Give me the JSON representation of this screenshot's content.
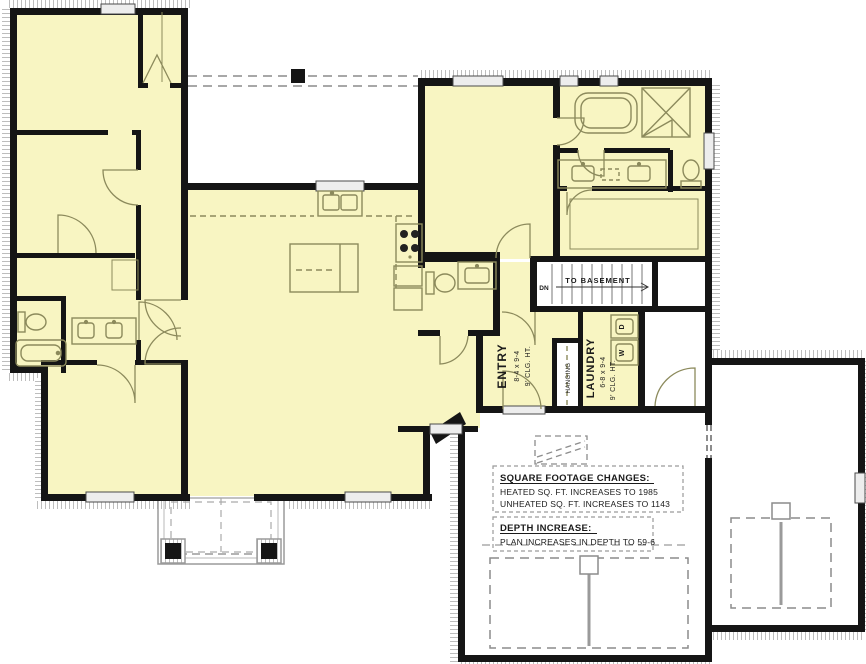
{
  "title": "First Floor Plan",
  "colors": {
    "heated_fill": "#F8F5C2",
    "wall": "#151515",
    "fixture_line": "#8C8A5C",
    "porch_line": "#9A9A9A",
    "hatch": "#BDBDBD",
    "window_fill": "#EDEDED",
    "text": "#1B1B1B"
  },
  "rooms": {
    "entry": {
      "name": "ENTRY",
      "dims": "8-4 x 9-4",
      "ceiling": "9' CLG. HT."
    },
    "laundry": {
      "name": "LAUNDRY",
      "dims": "6-8 x 9-4",
      "ceiling": "9' CLG. HT."
    },
    "closet": {
      "label": "HANGING"
    },
    "stairs": {
      "down": "DN",
      "direction": "TO BASEMENT"
    },
    "appliances": {
      "dryer": "D",
      "washer": "W"
    }
  },
  "notes": {
    "sqft_heading": "SQUARE FOOTAGE CHANGES:",
    "sqft_heated": "HEATED SQ. FT. INCREASES TO 1985",
    "sqft_unheated": "UNHEATED SQ. FT. INCREASES TO 1143",
    "depth_heading": "DEPTH INCREASE:",
    "depth_line": "PLAN INCREASES IN DEPTH TO 59-6"
  }
}
